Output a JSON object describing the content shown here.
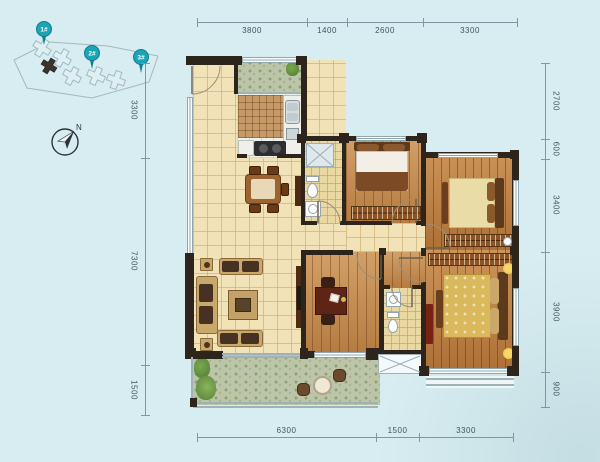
{
  "site_plan": {
    "pins": [
      {
        "label": "1#"
      },
      {
        "label": "2#"
      },
      {
        "label": "3#"
      }
    ]
  },
  "compass": {
    "north": "N"
  },
  "dims": {
    "top": [
      "3800",
      "1400",
      "2600",
      "3300"
    ],
    "left": [
      "3300",
      "7300",
      "1500"
    ],
    "right": [
      "2700",
      "600",
      "3400",
      "3900",
      "900"
    ],
    "bottom": [
      "6300",
      "1500",
      "3300"
    ]
  },
  "colors": {
    "background": "#d8edf2",
    "wall": "#2d241c",
    "pin_teal": "#1ba3b6",
    "tile_floor": "#f2e2b8",
    "wood_floor": "#c28a4e",
    "balcony_green": "#bcc5a8",
    "dimension_text": "#3f545c"
  }
}
